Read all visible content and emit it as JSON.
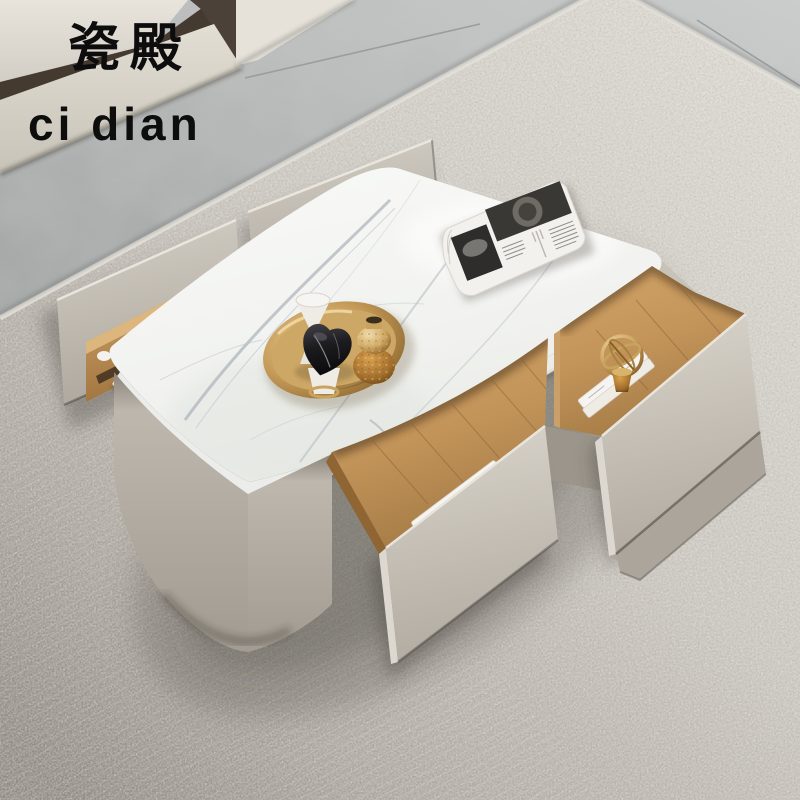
{
  "watermark": {
    "brand_cn": "瓷殿",
    "brand_en": "ci dian"
  },
  "palette": {
    "tile_floor": "#b5b8b7",
    "rug": "#cbc7c0",
    "cabinet_greige": "#cdc7bd",
    "marble_top": "#f4f5f3",
    "drawer_wood": "#c49a62",
    "gold_accent": "#c9a35e",
    "black_sculpture": "#1d1d1f"
  },
  "scene": {
    "floor_label": "grey ceramic tile floor",
    "rug_label": "light grey textured area rug",
    "tv_stand_label": "cream media cabinet (partially visible)",
    "table_label": "cream coffee table with white sintered-stone marble top",
    "drawers": [
      {
        "position": "back-left",
        "state": "open",
        "contents": "empty wood box"
      },
      {
        "position": "back-right",
        "state": "open",
        "contents": "empty wood box"
      },
      {
        "position": "front-middle",
        "state": "open",
        "contents": "stack of magazines"
      },
      {
        "position": "right-top",
        "state": "open",
        "contents": "gold armillary ornament on marble books"
      },
      {
        "position": "right-bottom",
        "state": "closed",
        "contents": ""
      }
    ],
    "tabletop": {
      "tray": "round gold metal tray",
      "tray_items": [
        "white hourglass ornament",
        "black marble heart sculpture on white pedestal",
        "gold textured vase"
      ],
      "magazine": "folded black-and-white magazine"
    },
    "drawer_books": {
      "spine_letter": "A"
    }
  }
}
